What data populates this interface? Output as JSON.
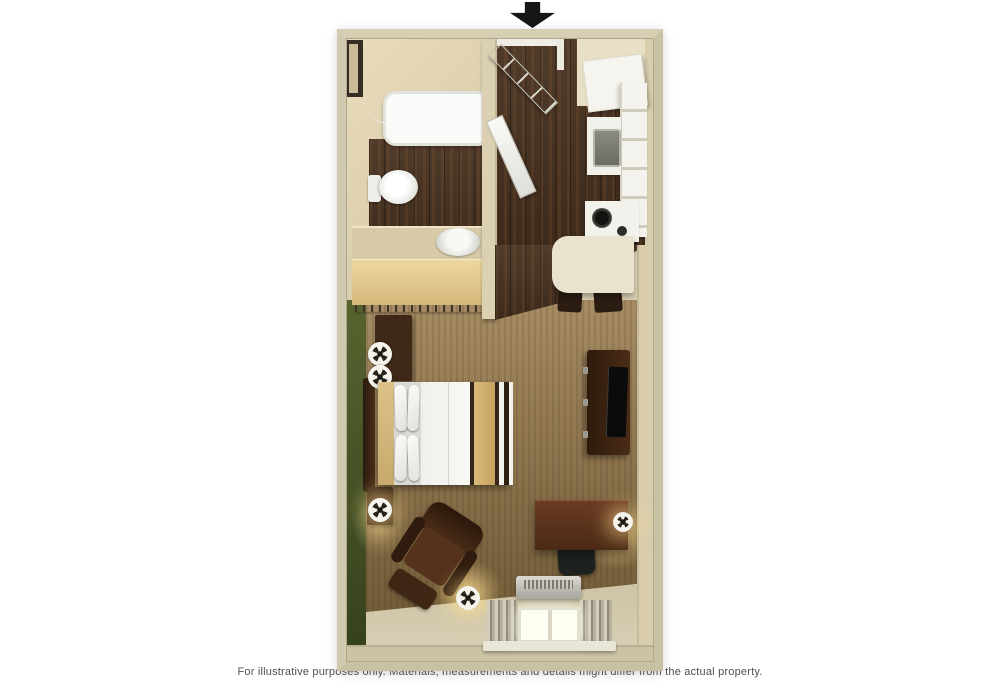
{
  "disclaimer": {
    "text": "For illustrative purposes only.  Materials, measurements and details might differ from the actual property."
  },
  "entrance_arrow": {
    "meaning": "entrance",
    "direction": "down",
    "color": "#161616"
  },
  "palette": {
    "background": "#ffffff",
    "outer_wall": "#c9c1a3",
    "interior_wall": "#d9cdae",
    "wood_floor": "#46301e",
    "carpet": "#97794a",
    "accent_wall_green": "#4a5828",
    "closet_wood": "#e0c78f",
    "fixture_white": "#f4f3ee",
    "dark_furniture": "#3f2817",
    "desk_wood": "#5f341f",
    "bed_runner_tan": "#d2b271",
    "lamp_glow": "#ffdd8c",
    "disclaimer_text": "#4f4f4f"
  },
  "floorplan": {
    "rooms": [
      "bathroom",
      "entry-hall",
      "kitchen",
      "closet",
      "living-sleeping-area"
    ],
    "furniture": [
      "bathtub",
      "shower-curtain",
      "toilet",
      "sink-basin",
      "closet-rod",
      "refrigerator",
      "kitchen-counter",
      "kitchen-sink",
      "stove-burners",
      "dining-table",
      "dining-chair",
      "dining-chair",
      "bed",
      "headboard",
      "pillows",
      "nightstand",
      "table-lamp",
      "armchair",
      "ottoman",
      "floor-lamp",
      "desk",
      "office-chair",
      "desk-lamp",
      "tv-stand",
      "television",
      "hvac-unit",
      "window",
      "curtains",
      "entry-door",
      "bathroom-door"
    ]
  }
}
